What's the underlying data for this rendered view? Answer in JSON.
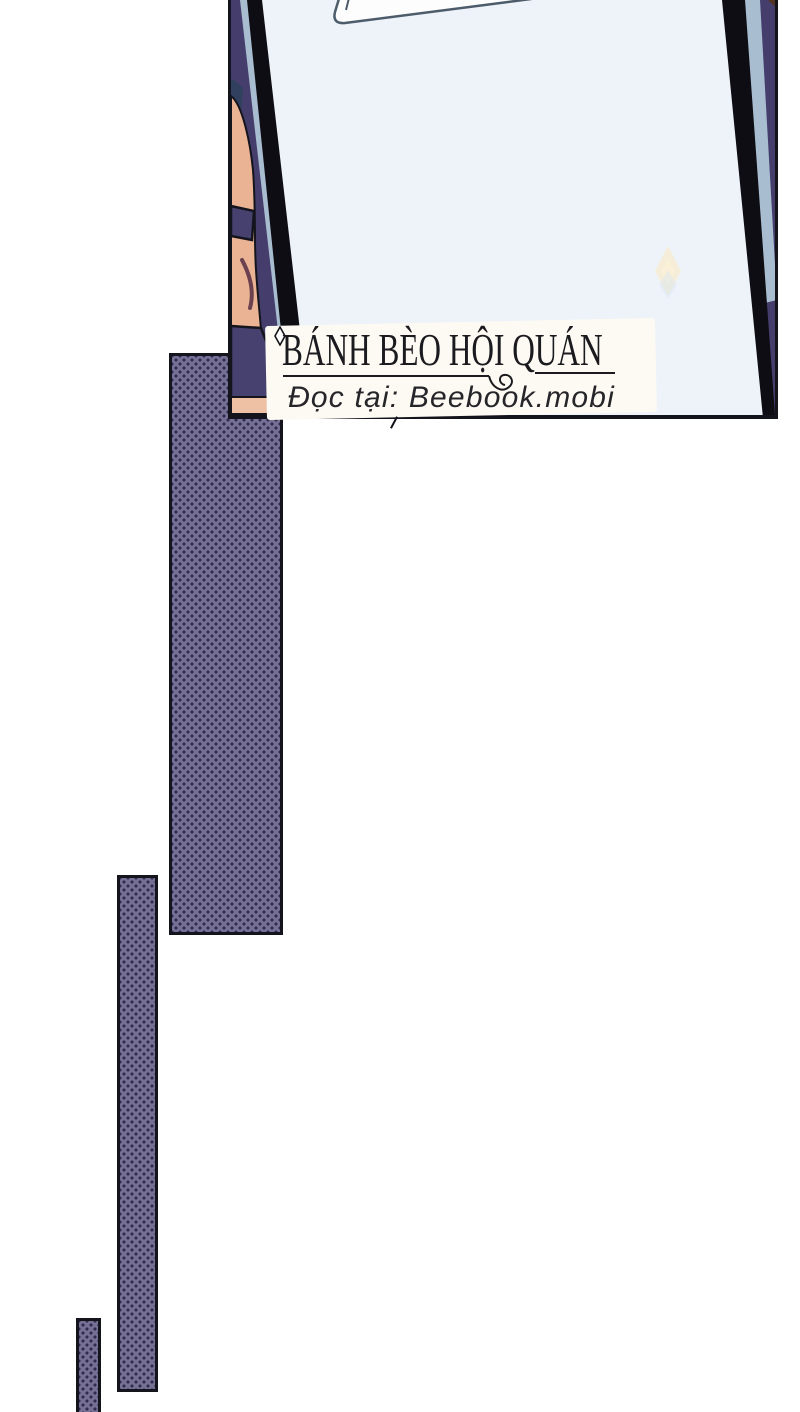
{
  "watermark": {
    "title": "BÁNH BÈO HỘI QUÁN",
    "subtitle": "Đọc tại: Beebook.mobi",
    "sparkle_icon": "four-point-diamond-icon"
  },
  "panel": {
    "content": "hand holding a large tilted blank card with a white paper clipped at top",
    "sparkle": "soft pale sparkle on card face"
  },
  "decorations": {
    "halftone_bars_count": 3
  },
  "colors": {
    "page-bg": "#ffffff",
    "panel-bg": "#453e6d",
    "card-face": "#eef2f9",
    "card-edge": "#0d0d13",
    "card-side": "#a9bdd0",
    "paper-white": "#fdfdfd",
    "paper-outline": "#4c5c6a",
    "ink": "#14141d",
    "skin": "#eab394",
    "skin-light": "#eec0a4",
    "sleeve": "#474170",
    "crease": "#6b4150",
    "hair-blue": "#31405e",
    "bar-fill": "#767095",
    "bar-dot": "#2e2a50",
    "sparkle-yellow": "#f6ecd2",
    "sparkle-blue": "#d8e6f2",
    "wm-box": "#fcfaf3",
    "text-dark": "#1b1b1f"
  }
}
